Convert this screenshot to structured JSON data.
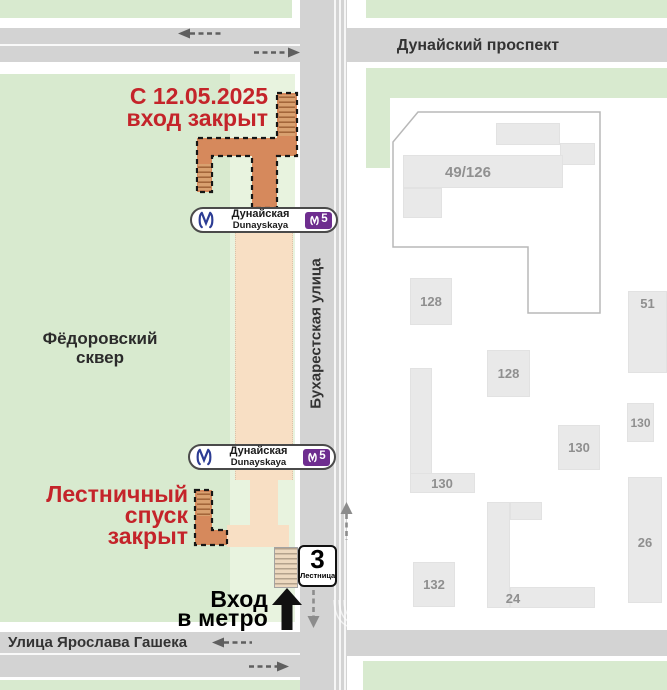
{
  "notice_top": {
    "line1": "С 12.05.2025",
    "line2": "вход закрыт"
  },
  "notice_bottom": {
    "line1": "Лестничный",
    "line2": "спуск",
    "line3": "закрыт"
  },
  "entrance_label": {
    "line1": "Вход",
    "line2": "в метро"
  },
  "park_label": {
    "line1": "Фёдоровский",
    "line2": "сквер"
  },
  "streets": {
    "top": "Дунайский проспект",
    "vertical": "Бухарестская улица",
    "bottom": "Улица Ярослава Гашека"
  },
  "station_badge": {
    "name_ru": "Дунайская",
    "name_en": "Dunayskaya",
    "line_number": "5"
  },
  "stairs_badge": {
    "number": "3",
    "label": "Лестница"
  },
  "buildings": {
    "main": "49/126",
    "b128a": "128",
    "b128b": "128",
    "b51": "51",
    "b130a": "130",
    "b130b": "130",
    "b130c": "130",
    "b26": "26",
    "b132": "132",
    "b24": "24"
  },
  "colors": {
    "park_green": "#d8eacf",
    "park_green_light": "#e8f3df",
    "street_gray": "#d3d3d3",
    "building_gray": "#e9e9e9",
    "corridor_closed_orange": "#d6895c",
    "corridor_open_peach": "#f8dfc4",
    "notice_red": "#c4242a",
    "metro_blue": "#2c3c94",
    "line5_purple": "#6e2d8f"
  }
}
